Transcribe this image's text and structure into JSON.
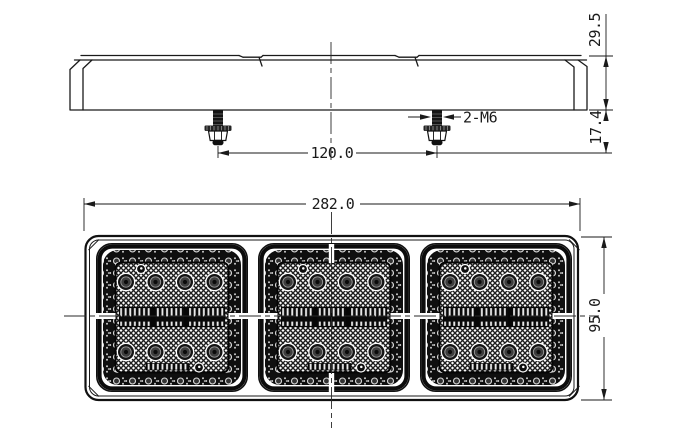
{
  "drawing": {
    "background_color": "#ffffff",
    "line_color": "#1a1a1a",
    "side_view": {
      "dim_height": "29.5",
      "dim_bolt_length": "17.4",
      "dim_bolt_spacing": "120.0",
      "bolt_spec": "2-M6",
      "mounting_bolts": 2
    },
    "front_view": {
      "dim_width": "282.0",
      "dim_height": "95.0",
      "lens_sections": 3,
      "round_leds_per_section": 8,
      "led_bar_per_section": 1
    }
  }
}
